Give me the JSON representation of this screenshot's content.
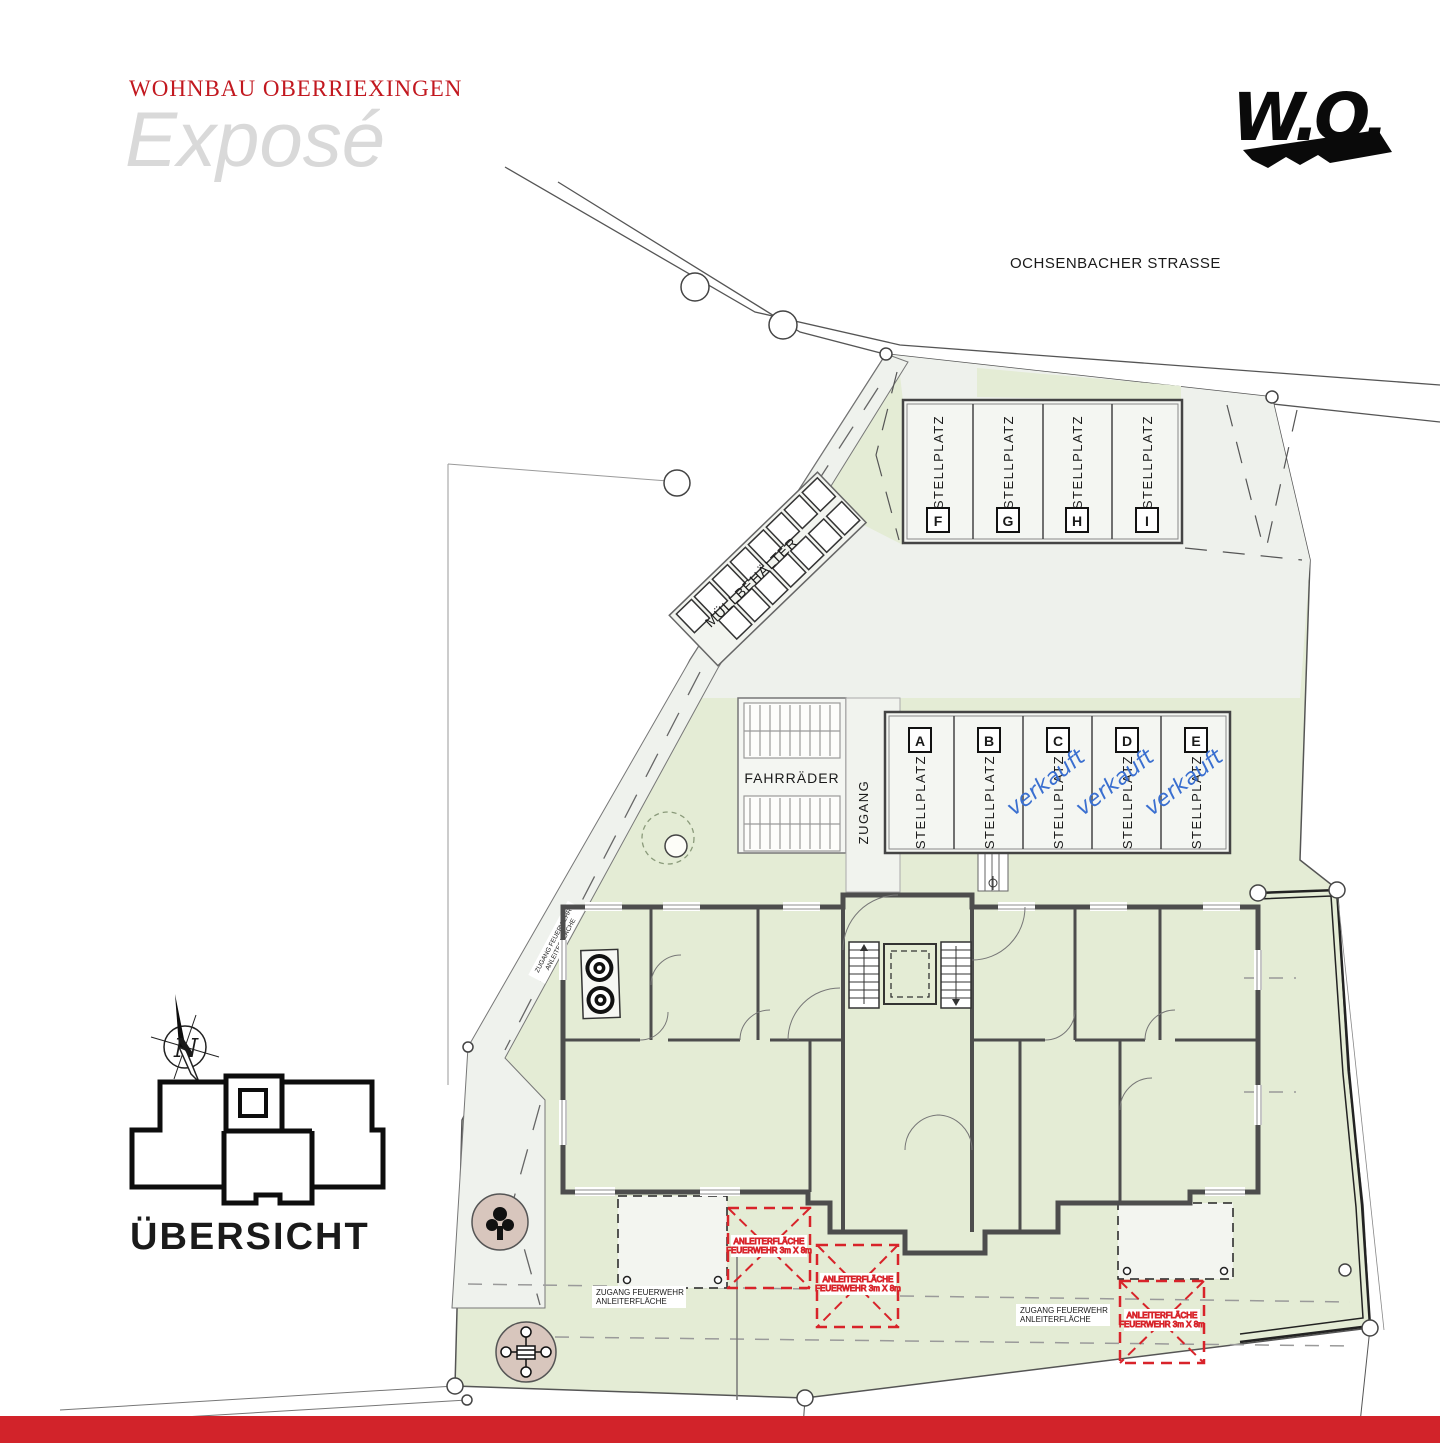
{
  "header": {
    "brand": "WOHNBAU OBERRIEXINGEN",
    "title": "Exposé",
    "logo_text": "W.O."
  },
  "street": {
    "name": "OCHSENBACHER STRASSE"
  },
  "site": {
    "waste_label": "MÜLLBEHÄLTER",
    "bikes_label": "FAHRRÄDER",
    "access_label": "ZUGANG",
    "overview_label": "ÜBERSICHT",
    "north_label": "N"
  },
  "parking": {
    "stall_label": "STELLPLATZ",
    "sold_label": "verkauft",
    "top_row": [
      {
        "id": "F"
      },
      {
        "id": "G"
      },
      {
        "id": "H"
      },
      {
        "id": "I"
      }
    ],
    "bottom_row": [
      {
        "id": "A",
        "sold": false
      },
      {
        "id": "B",
        "sold": false
      },
      {
        "id": "C",
        "sold": true
      },
      {
        "id": "D",
        "sold": true
      },
      {
        "id": "E",
        "sold": true
      }
    ]
  },
  "fire": {
    "access_line1": "ZUGANG FEUERWEHR",
    "access_line2": "ANLEITERFLÄCHE",
    "areas": [
      {
        "line1": "ANLEITERFLÄCHE",
        "line2": "FEUERWEHR 3m X 8m"
      },
      {
        "line1": "ANLEITERFLÄCHE",
        "line2": "FEUERWEHR 3m X 8m"
      },
      {
        "line1": "ANLEITERFLÄCHE",
        "line2": "FEUERWEHR 3m X 8m"
      }
    ]
  },
  "colors": {
    "accent_red": "#d2232a",
    "brand_red": "#c2181f",
    "lawn_green": "#e4ecd5",
    "paving": "#eef1ec",
    "wall_gray": "#4d4d4d",
    "sold_blue": "#3a6fd0",
    "fire_red": "#d8232a",
    "title_gray": "#d9d9d9"
  }
}
